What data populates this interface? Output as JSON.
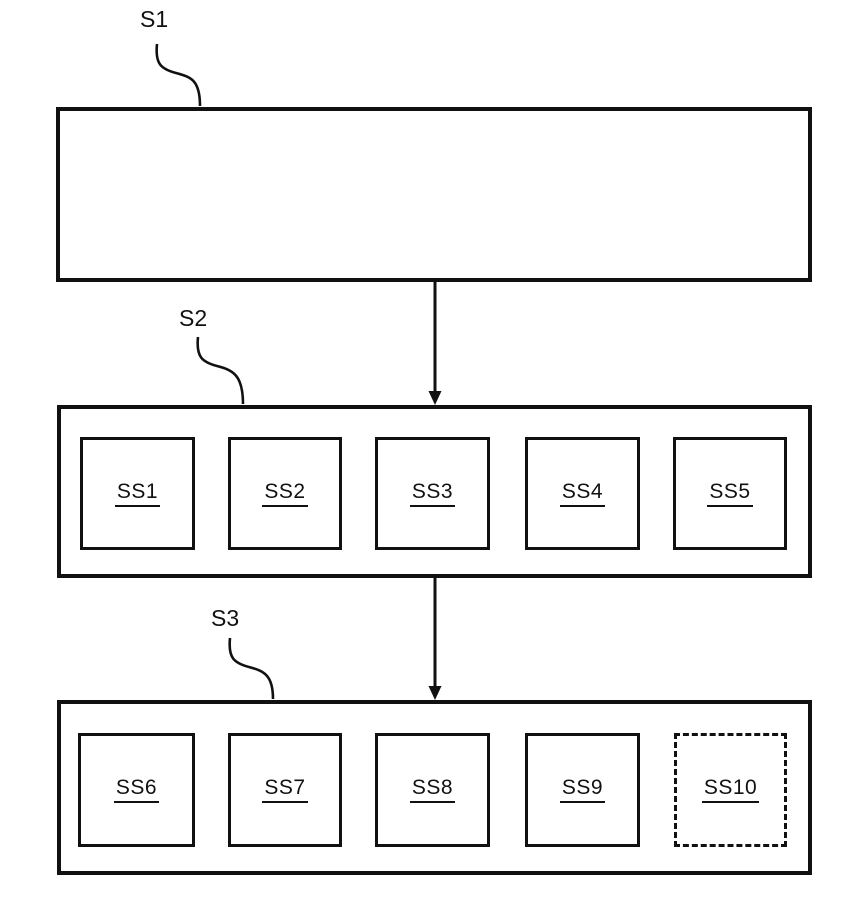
{
  "figure": {
    "background_color": "#ffffff",
    "line_color": "#111111",
    "stages": {
      "s1": {
        "label": "S1",
        "substeps": []
      },
      "s2": {
        "label": "S2",
        "substeps": [
          {
            "label": "SS1",
            "border": "solid"
          },
          {
            "label": "SS2",
            "border": "solid"
          },
          {
            "label": "SS3",
            "border": "solid"
          },
          {
            "label": "SS4",
            "border": "solid"
          },
          {
            "label": "SS5",
            "border": "solid"
          }
        ]
      },
      "s3": {
        "label": "S3",
        "substeps": [
          {
            "label": "SS6",
            "border": "solid"
          },
          {
            "label": "SS7",
            "border": "solid"
          },
          {
            "label": "SS8",
            "border": "solid"
          },
          {
            "label": "SS9",
            "border": "solid"
          },
          {
            "label": "SS10",
            "border": "dashed"
          }
        ]
      }
    },
    "connectors": {
      "s1_to_s2": "solid-arrow-down",
      "s2_to_s3": "solid-arrow-down",
      "ss9_to_ss10": "dashed-arrow-right"
    }
  }
}
